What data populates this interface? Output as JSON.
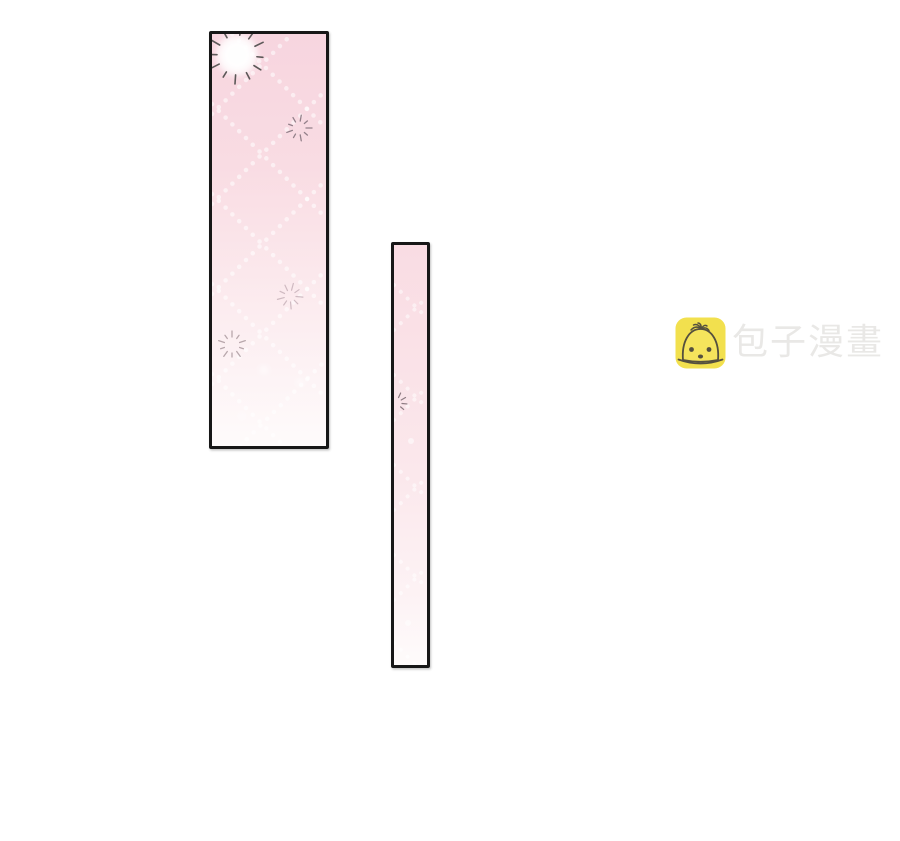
{
  "watermark": {
    "text": "包子漫畫",
    "icon": "baozi-mascot-icon"
  },
  "panels": [
    {
      "name": "comic-panel-large",
      "decorations": [
        "sunburst-icon",
        "sparkle-icon",
        "lattice-dots-pattern"
      ]
    },
    {
      "name": "comic-panel-narrow",
      "decorations": [
        "sparkle-icon",
        "lattice-dots-pattern"
      ]
    }
  ],
  "colors": {
    "page-bg": "#ffffff",
    "panel-border": "#171717",
    "pink-top": "#f7d5df",
    "pink-upper": "#f9dce3",
    "pink-mid": "#fbe8ec",
    "pink-low": "#fdf3f5",
    "pink-bottom": "#fefbfb",
    "lattice-dot": "#ffffff",
    "sunburst-ray": "#5c5858",
    "sparkle-dark": "#93808a",
    "sparkle-soft": "#c8b2ba",
    "sparkle-gray": "#b1a0a5",
    "logo-yellow": "#f2e04e",
    "logo-bun": "#f5e45c",
    "logo-outline": "#55503e",
    "logo-text": "#e9e8e6"
  }
}
